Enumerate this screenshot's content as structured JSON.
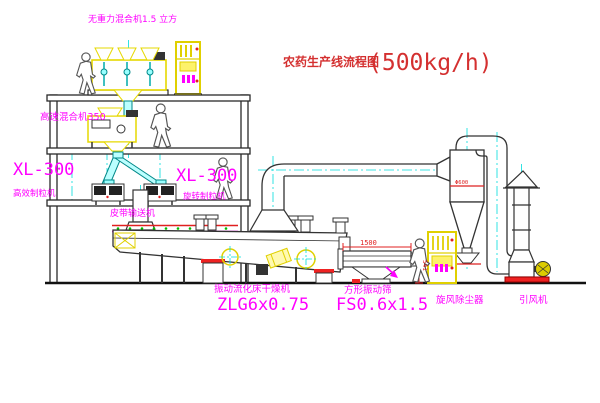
{
  "title": {
    "name": "农药生产线流程图",
    "capacity": "(500kg/h)"
  },
  "equipment": {
    "gravity_mixer": {
      "label": "无重力混合机1.5 立方"
    },
    "high_speed_mixer": {
      "label": "高速混合机350"
    },
    "granulator_left": {
      "model": "XL-300",
      "label": "高效制粒机"
    },
    "granulator_right": {
      "model": "XL-300",
      "label": "旋转制粒机"
    },
    "belt_conveyor": {
      "label": "皮带输送机"
    },
    "fluid_bed_dryer": {
      "label": "振动流化床干燥机",
      "model": "ZLG6x0.75"
    },
    "vibrating_screen": {
      "label": "方形振动筛",
      "model": "FS0.6x1.5"
    },
    "cyclone": {
      "label": "旋风除尘器",
      "dimension": "Φ600"
    },
    "fan": {
      "label": "引风机"
    }
  },
  "dimensions": {
    "screen_width": "1500",
    "screen_height": "541"
  },
  "colors": {
    "machine_yellow": "#e6d800",
    "centerline_cyan": "#00dddd",
    "label_magenta": "#ff00ff",
    "title_red": "#d43030",
    "dimension_red": "#e02020",
    "line_black": "#2a2a2a"
  }
}
